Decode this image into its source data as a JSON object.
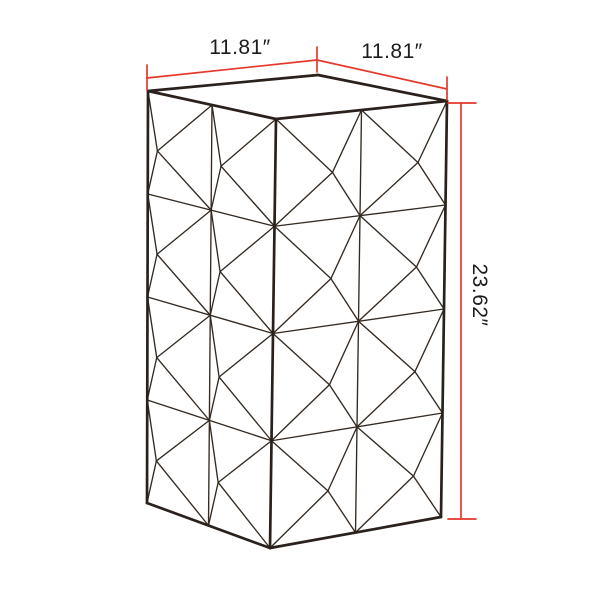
{
  "page": {
    "background": "#ffffff",
    "description_label": "faceted-pedestal-dimension-diagram"
  },
  "colors": {
    "outline": "#2a211c",
    "pattern_line": "#342a21",
    "dimension_red": "#e5382c",
    "label_text": "#1d1c1a",
    "background": "#ffffff"
  },
  "dimensions": {
    "width_left": {
      "label": "11.81″",
      "label_pos": {
        "x": 240,
        "y": 48,
        "rotate": 0
      }
    },
    "width_right": {
      "label": "11.81″",
      "label_pos": {
        "x": 392,
        "y": 52,
        "rotate": 0
      }
    },
    "height": {
      "label": "23.62″",
      "label_pos": {
        "x": 479,
        "y": 295,
        "rotate": 90
      }
    }
  },
  "diagram": {
    "canvas": {
      "width": 600,
      "height": 600
    },
    "line_widths": {
      "outline": 2.7,
      "pattern": 1.35,
      "dimension": 1.7
    },
    "box": {
      "top_face": [
        [
          148,
          91
        ],
        [
          318,
          75
        ],
        [
          447,
          101
        ],
        [
          276,
          119
        ]
      ],
      "vertical_edges": [
        [
          [
            148,
            91
          ],
          [
            147,
            503
          ]
        ],
        [
          [
            276,
            119
          ],
          [
            270,
            548
          ]
        ],
        [
          [
            447,
            101
          ],
          [
            441,
            517
          ]
        ]
      ],
      "bottom_edges": [
        [
          [
            147,
            503
          ],
          [
            270,
            548
          ]
        ],
        [
          [
            270,
            548
          ],
          [
            441,
            517
          ]
        ]
      ]
    },
    "faces": [
      {
        "name": "left-face",
        "corners": [
          [
            148,
            91
          ],
          [
            276,
            119
          ],
          [
            270,
            548
          ],
          [
            147,
            503
          ]
        ],
        "cols": 2,
        "rows": 4,
        "apex_u": 0.15,
        "apex_v": 0.56
      },
      {
        "name": "right-face",
        "corners": [
          [
            276,
            119
          ],
          [
            447,
            101
          ],
          [
            441,
            517
          ],
          [
            270,
            548
          ]
        ],
        "cols": 2,
        "rows": 4,
        "apex_u": 0.67,
        "apex_v": 0.56
      }
    ],
    "dimension_segments": [
      [
        147,
        78,
        317,
        60
      ],
      [
        317,
        60,
        447,
        89
      ],
      [
        147,
        65,
        147,
        90
      ],
      [
        317,
        47,
        317,
        72
      ],
      [
        447,
        77,
        447,
        100
      ],
      [
        461,
        103,
        461,
        519
      ],
      [
        448,
        103,
        476,
        103
      ],
      [
        448,
        519,
        476,
        519
      ]
    ]
  }
}
